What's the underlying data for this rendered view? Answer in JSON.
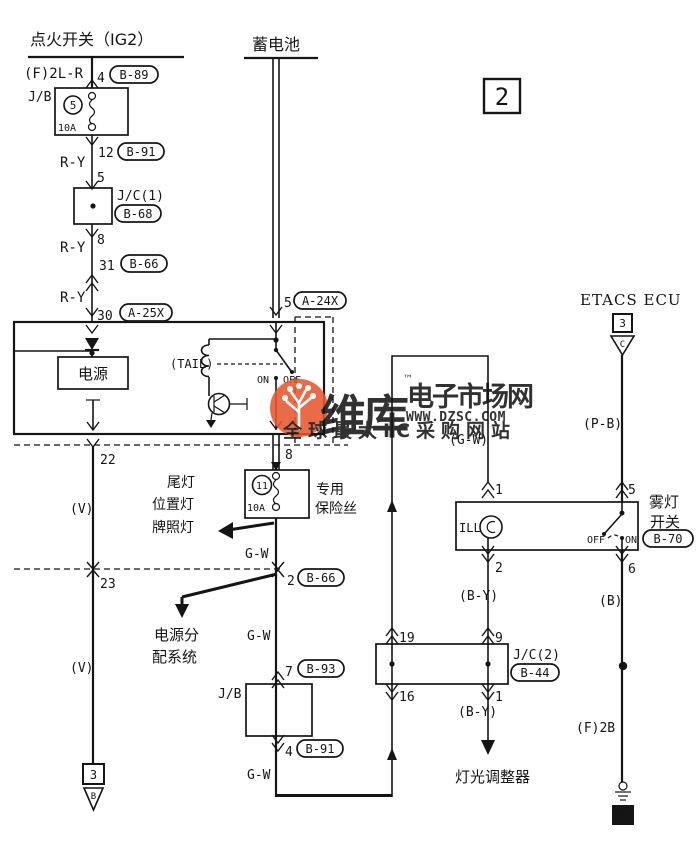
{
  "page": {
    "number": "2"
  },
  "colors": {
    "ink": "#151515",
    "watermark": "#e8572e"
  },
  "watermark": {
    "brand": "维库",
    "tm": "™",
    "title": "电子市场网",
    "url": "WWW.DZSC.COM",
    "slogan": "全球最大IC采购网站"
  },
  "ignition": {
    "title": "点火开关（IG2）",
    "wire_in": "(F)2L-R",
    "pin_in": "4",
    "conn_in": "B-89",
    "jb": "J/B",
    "fuse_no": "5",
    "fuse_amp": "10A",
    "pin_12": "12",
    "conn_12": "B-91",
    "wire_ry": "R-Y",
    "pin_5": "5",
    "jc1": "J/C(1)",
    "jc1_conn": "B-68",
    "pin_8": "8",
    "pin_31": "31",
    "conn_31": "B-66",
    "pin_30": "30",
    "conn_30": "A-25X"
  },
  "battery": {
    "title": "蓄电池",
    "pin_5": "5",
    "conn": "A-24X"
  },
  "unit": {
    "power": "电源",
    "tail": "(TAIL)",
    "on": "ON",
    "off": "OFF",
    "pin_22": "22",
    "pin_8": "8"
  },
  "left_run": {
    "wire_v": "(V)",
    "pin_23": "23",
    "term_no": "3",
    "term_code": "B"
  },
  "tail_feed": {
    "fuse_no": "11",
    "fuse_amp": "10A",
    "fuse_name_1": "专用",
    "fuse_name_2": "保险丝",
    "lamps_1": "尾灯",
    "lamps_2": "位置灯",
    "lamps_3": "牌照灯",
    "wire_gw": "G-W",
    "pin_2": "2",
    "conn_2": "B-66",
    "dist_1": "电源分",
    "dist_2": "配系统",
    "pin_7": "7",
    "conn_7": "B-93",
    "jb": "J/B",
    "pin_4": "4",
    "conn_4": "B-91"
  },
  "illumination": {
    "wire_gw": "(G-W)",
    "pin_1": "1",
    "ill": "ILL",
    "pin_2": "2",
    "wire_by": "(B-Y)",
    "pin_19": "19",
    "pin_9": "9",
    "jc2": "J/C(2)",
    "jc2_conn": "B-44",
    "pin_16": "16",
    "pin_1b": "1",
    "load": "灯光调整器"
  },
  "etacs": {
    "title": "ETACS ECU",
    "term_no": "3",
    "term_code": "C",
    "wire_pb": "(P-B)",
    "pin_5": "5",
    "fog_1": "雾灯",
    "fog_2": "开关",
    "conn": "B-70",
    "off": "OFF",
    "on": "ON",
    "pin_6": "6",
    "wire_b": "(B)",
    "wire_f2b": "(F)2B",
    "ground_no": "6"
  }
}
